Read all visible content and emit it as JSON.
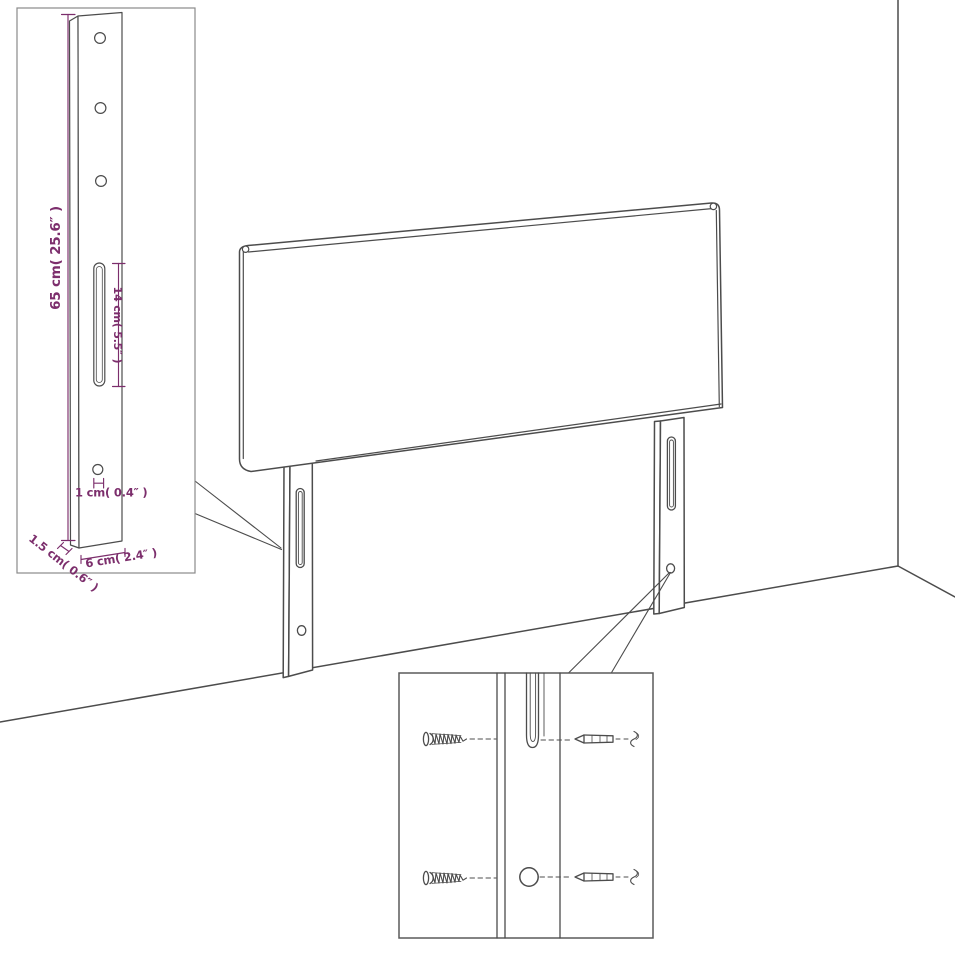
{
  "diagram": {
    "kind": "product-dimension-line-drawing",
    "subject": "upholstered headboard with two slotted mounting legs in a room corner",
    "colors": {
      "line": "#4c4c4c",
      "dimension": "#7c2e6c",
      "inset_border": "#8a8a8a",
      "background": "#ffffff"
    },
    "bracket_inset": {
      "description": "close-up of mounting leg bracket with holes and slot",
      "dimensions": {
        "height": "65 cm( 25.6″ )",
        "slot_length": "14 cm( 5.5″ )",
        "hole_diameter": "1 cm( 0.4″ )",
        "thickness": "1.5 cm( 0.6″ )",
        "width": "6 cm( 2.4″ )"
      }
    },
    "screw_inset": {
      "description": "close-up of leg slot and hole with wood screws and machine screws alignment",
      "hardware": [
        "wood-screw",
        "wood-screw",
        "machine-screw",
        "machine-screw"
      ]
    }
  }
}
